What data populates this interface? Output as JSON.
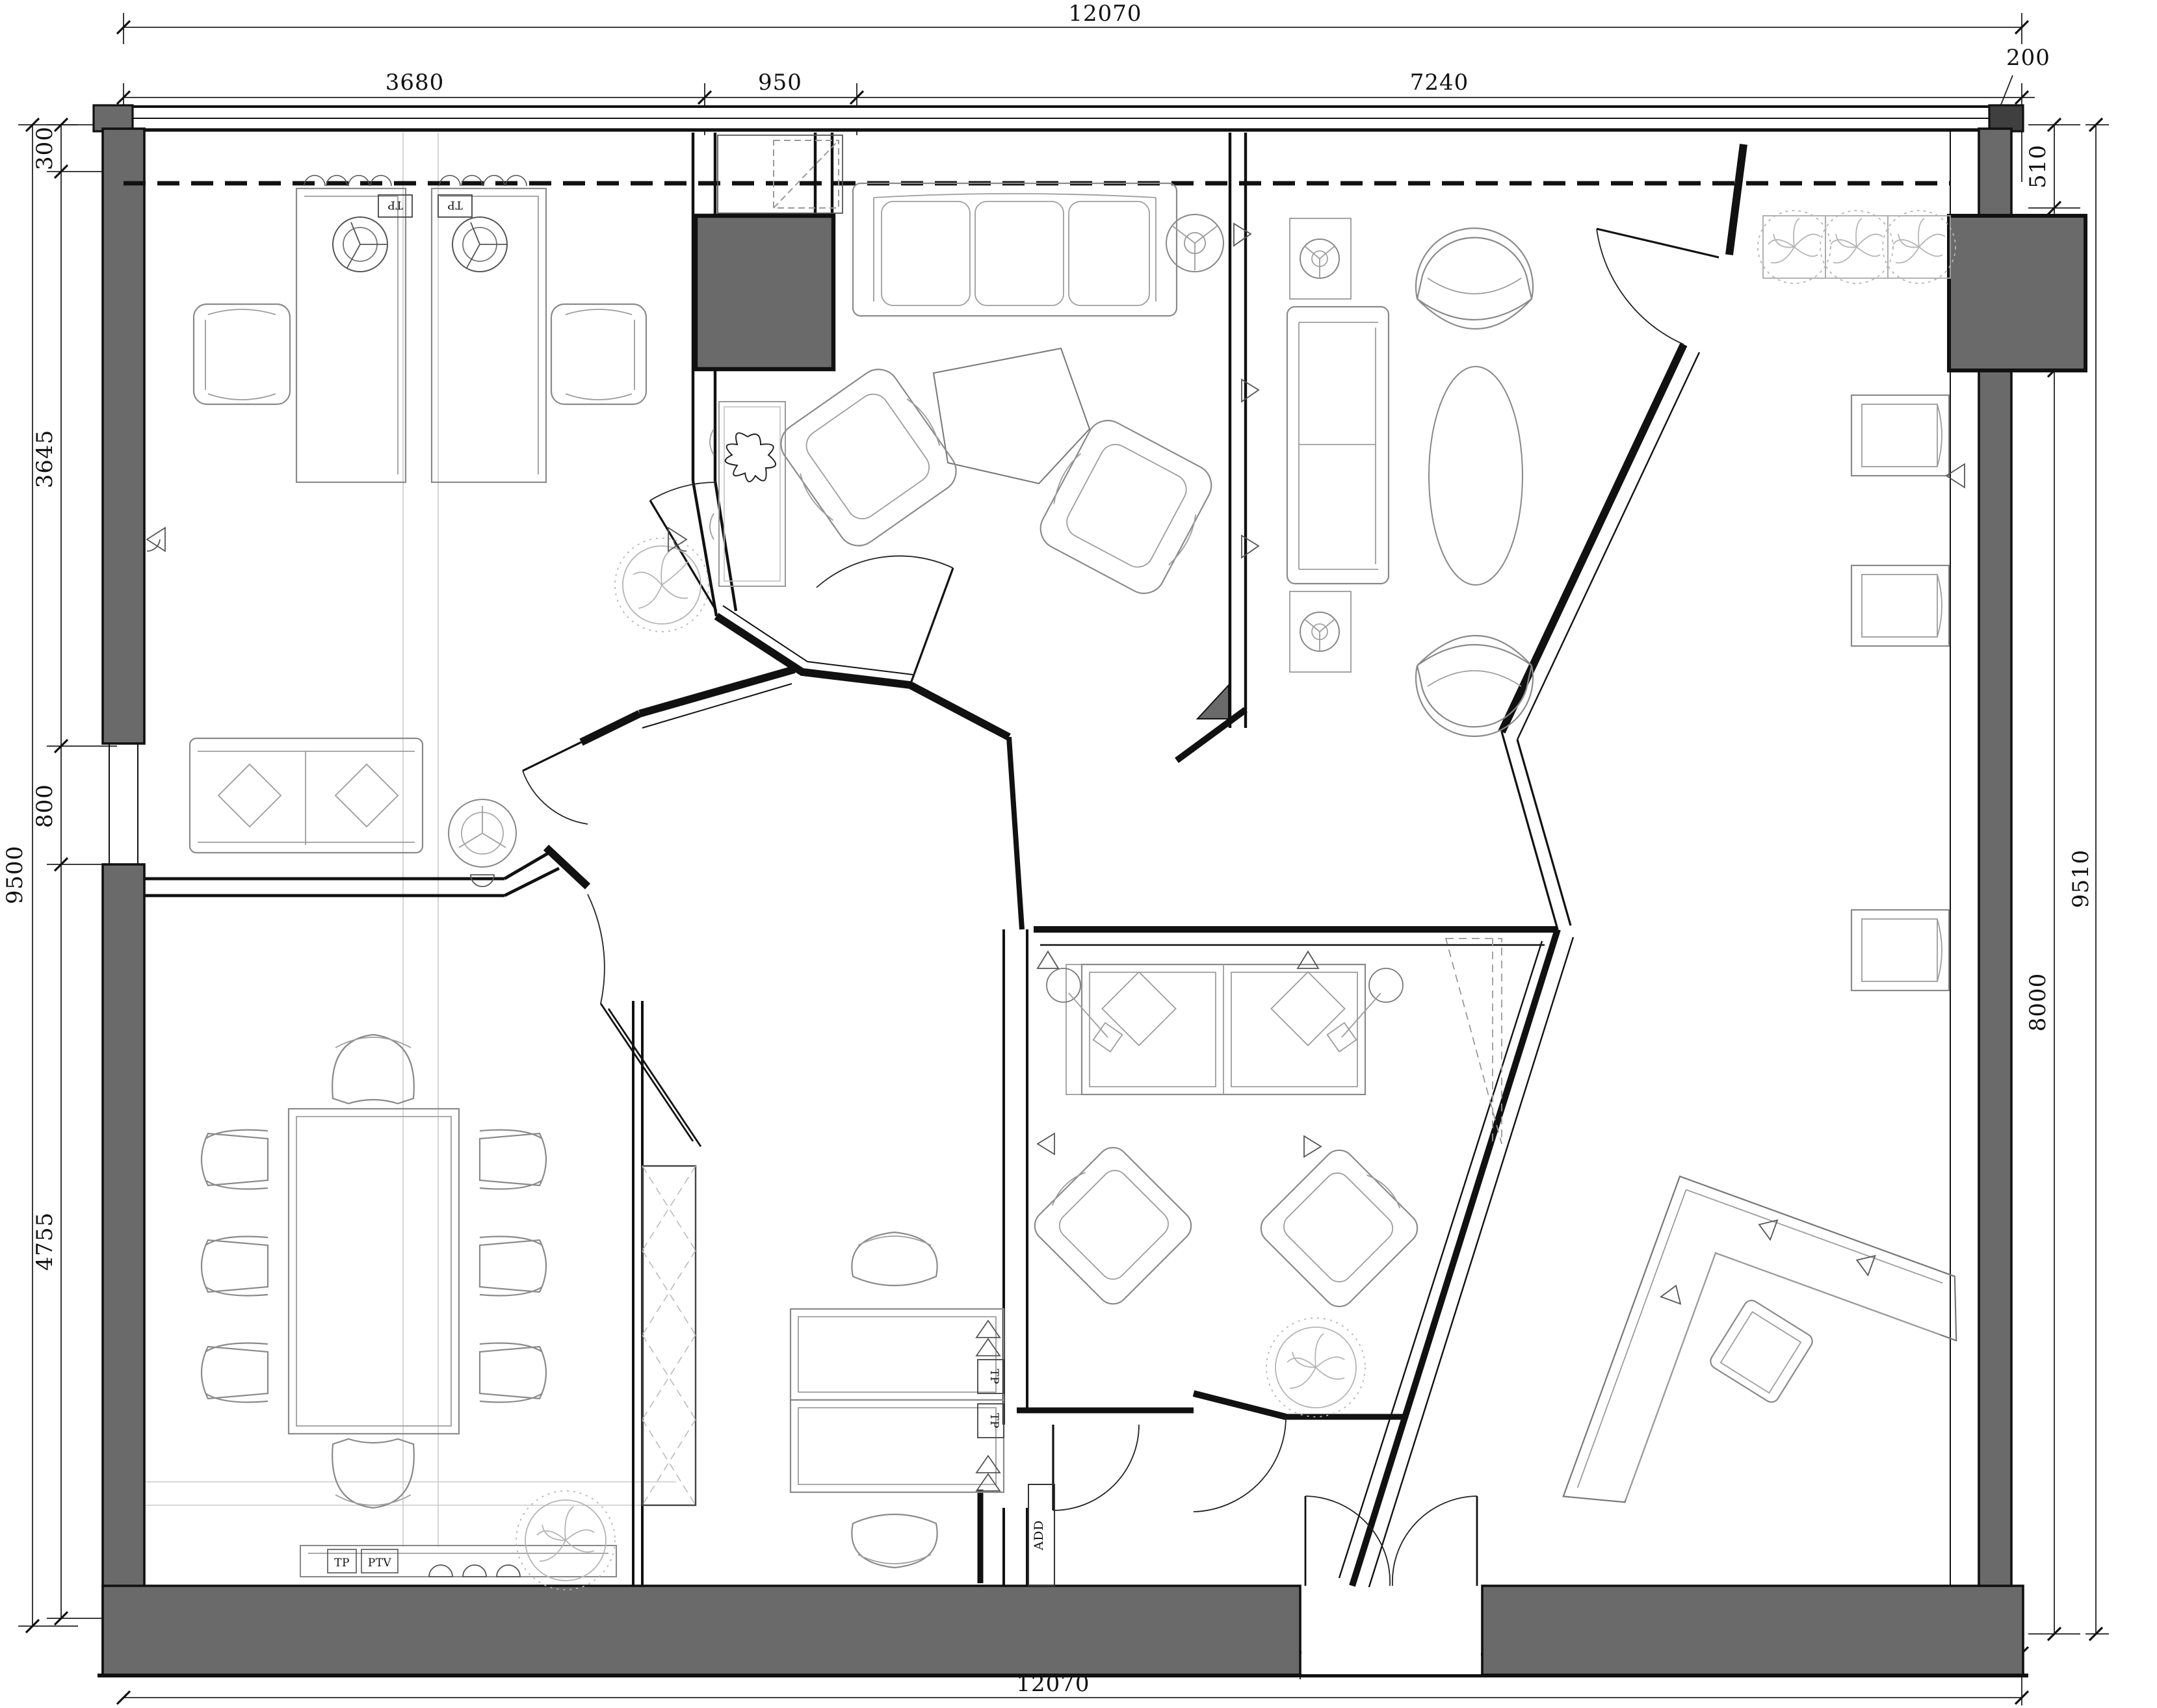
{
  "drawing": {
    "type": "architectural-floor-plan",
    "units": "mm",
    "colors": {
      "wall_fill": "#6a6a6a",
      "wall_dark": "#3f3f3f",
      "line": "#111111",
      "furniture_line": "#8a8a8a",
      "tree_line": "#b5b5b5"
    },
    "dimensions": {
      "top": {
        "overall": "12070",
        "segments": [
          "3680",
          "950",
          "7240"
        ],
        "offset_right": "200"
      },
      "bottom": {
        "overall": "12070",
        "segments": [
          "7625",
          "1200",
          "3245"
        ]
      },
      "left": {
        "overall": "9500",
        "segments": [
          "300",
          "3645",
          "800",
          "4755"
        ]
      },
      "right": {
        "overall": "9510",
        "segments": [
          "510",
          "1000",
          "8000"
        ]
      }
    },
    "labels": {
      "tp": "TP",
      "ptv": "PTV",
      "add": "ADD"
    }
  }
}
